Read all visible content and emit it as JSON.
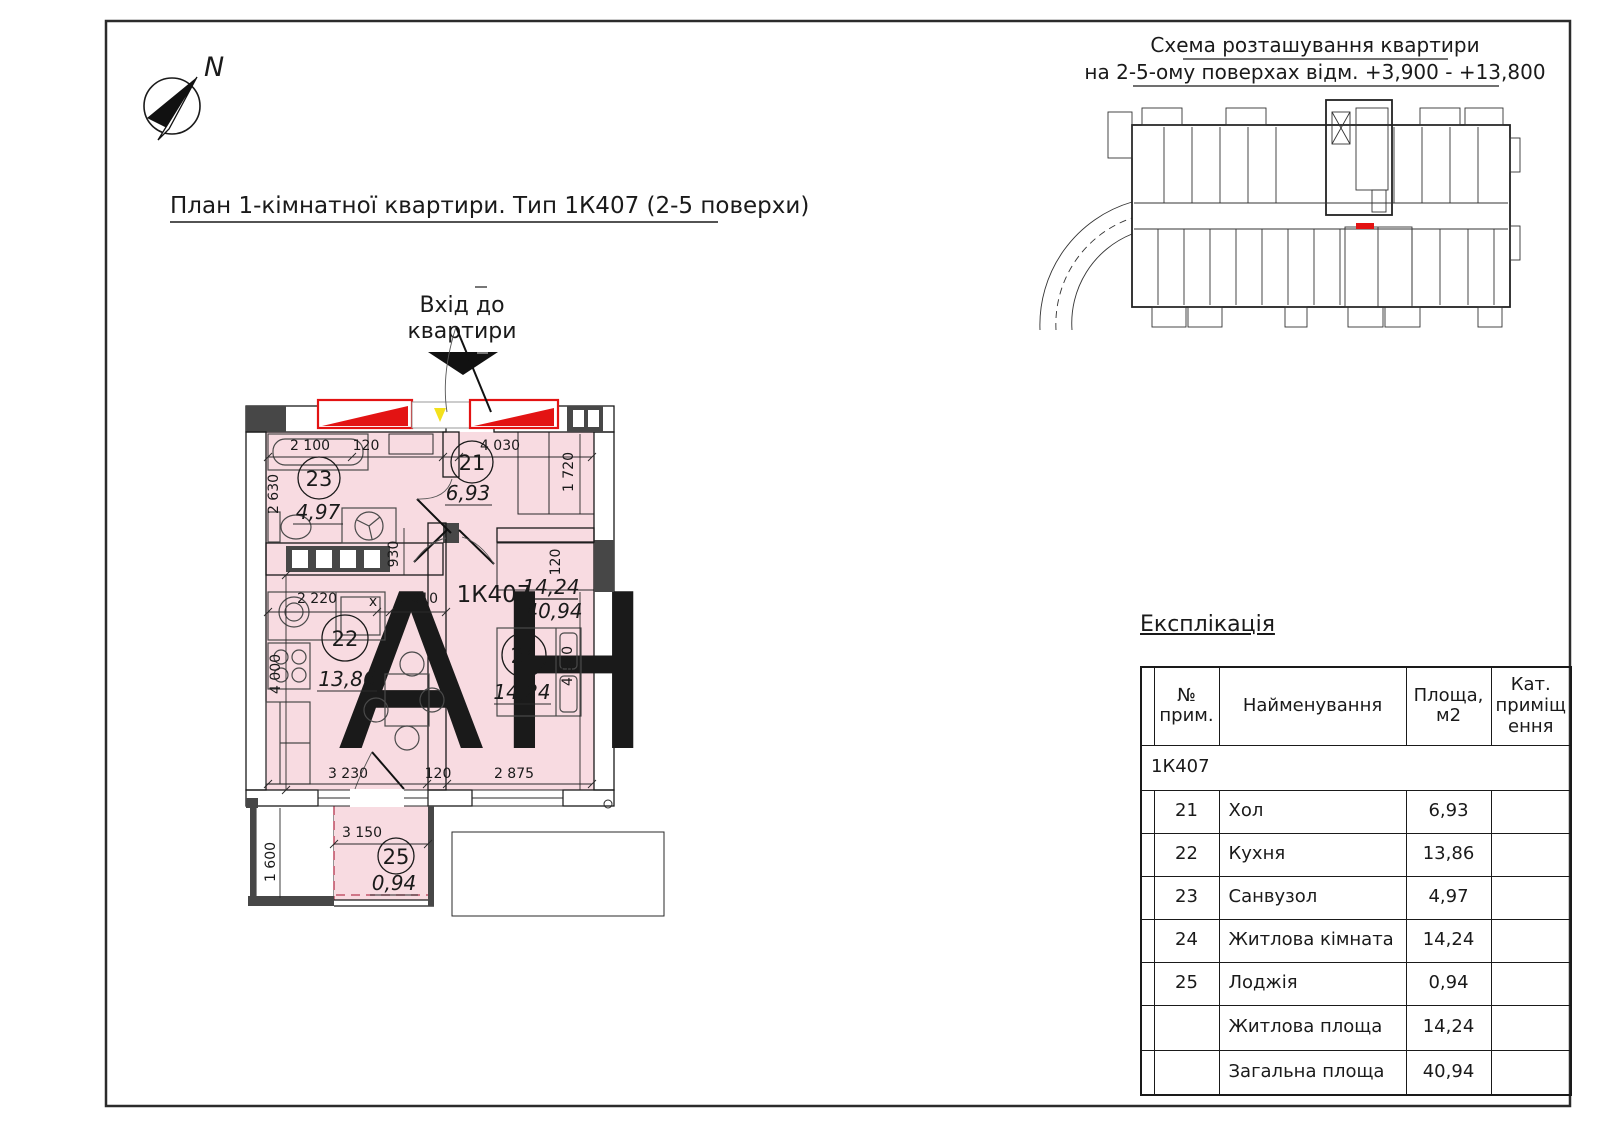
{
  "page": {
    "title": "План 1-кімнатної квартири. Тип 1К407 (2-5 поверхи)",
    "north_label": "N",
    "watermark": "АН"
  },
  "entrance": {
    "line1": "Вхід до",
    "line2": "квартири"
  },
  "scheme": {
    "title_line1": "Схема розташування квартири",
    "title_line2": "на 2-5-ому поверхах відм. +3,900 - +13,800"
  },
  "plan": {
    "apartment_code": "1К407",
    "living_area": "14,24",
    "total_area": "40,94",
    "rooms": [
      {
        "number": "21",
        "area": "6,93"
      },
      {
        "number": "22",
        "area": "13,86"
      },
      {
        "number": "23",
        "area": "4,97"
      },
      {
        "number": "24",
        "area": "14,24"
      },
      {
        "number": "25",
        "area": "0,94"
      }
    ],
    "dims": {
      "bath_width": "2 100",
      "bath_gap": "120",
      "bath_depth": "2 630",
      "hall_width": "4 030",
      "hall_closet_depth": "1 720",
      "hall_closet_thk": "120",
      "passage": "930",
      "kitchen_seg_a": "2 220",
      "kitchen_seg_x": "x",
      "kitchen_seg_b": "1 010",
      "kitchen_width": "3 230",
      "kitchen_wall": "120",
      "kitchen_depth": "4 000",
      "room_width": "2 875",
      "room_depth": "4 930",
      "loggia_width": "3 150",
      "loggia_depth": "1 600"
    }
  },
  "colors": {
    "room_fill": "#f8dbe1",
    "accent_red": "#e31313",
    "wall_dark": "#474747"
  },
  "table": {
    "title": "Експлікація",
    "headers": {
      "col1": [
        "№",
        "прим."
      ],
      "col2": [
        "Найменування"
      ],
      "col3": [
        "Площа,",
        "м2"
      ],
      "col4": [
        "Кат.",
        "приміщ",
        "ення"
      ]
    },
    "group_row": "1К407",
    "rows": [
      {
        "num": "21",
        "name": "Хол",
        "area": "6,93",
        "cat": ""
      },
      {
        "num": "22",
        "name": "Кухня",
        "area": "13,86",
        "cat": ""
      },
      {
        "num": "23",
        "name": "Санвузол",
        "area": "4,97",
        "cat": ""
      },
      {
        "num": "24",
        "name": "Житлова кімната",
        "area": "14,24",
        "cat": ""
      },
      {
        "num": "25",
        "name": "Лоджія",
        "area": "0,94",
        "cat": ""
      },
      {
        "num": "",
        "name": "Житлова площа",
        "area": "14,24",
        "cat": ""
      },
      {
        "num": "",
        "name": "Загальна площа",
        "area": "40,94",
        "cat": ""
      }
    ]
  }
}
